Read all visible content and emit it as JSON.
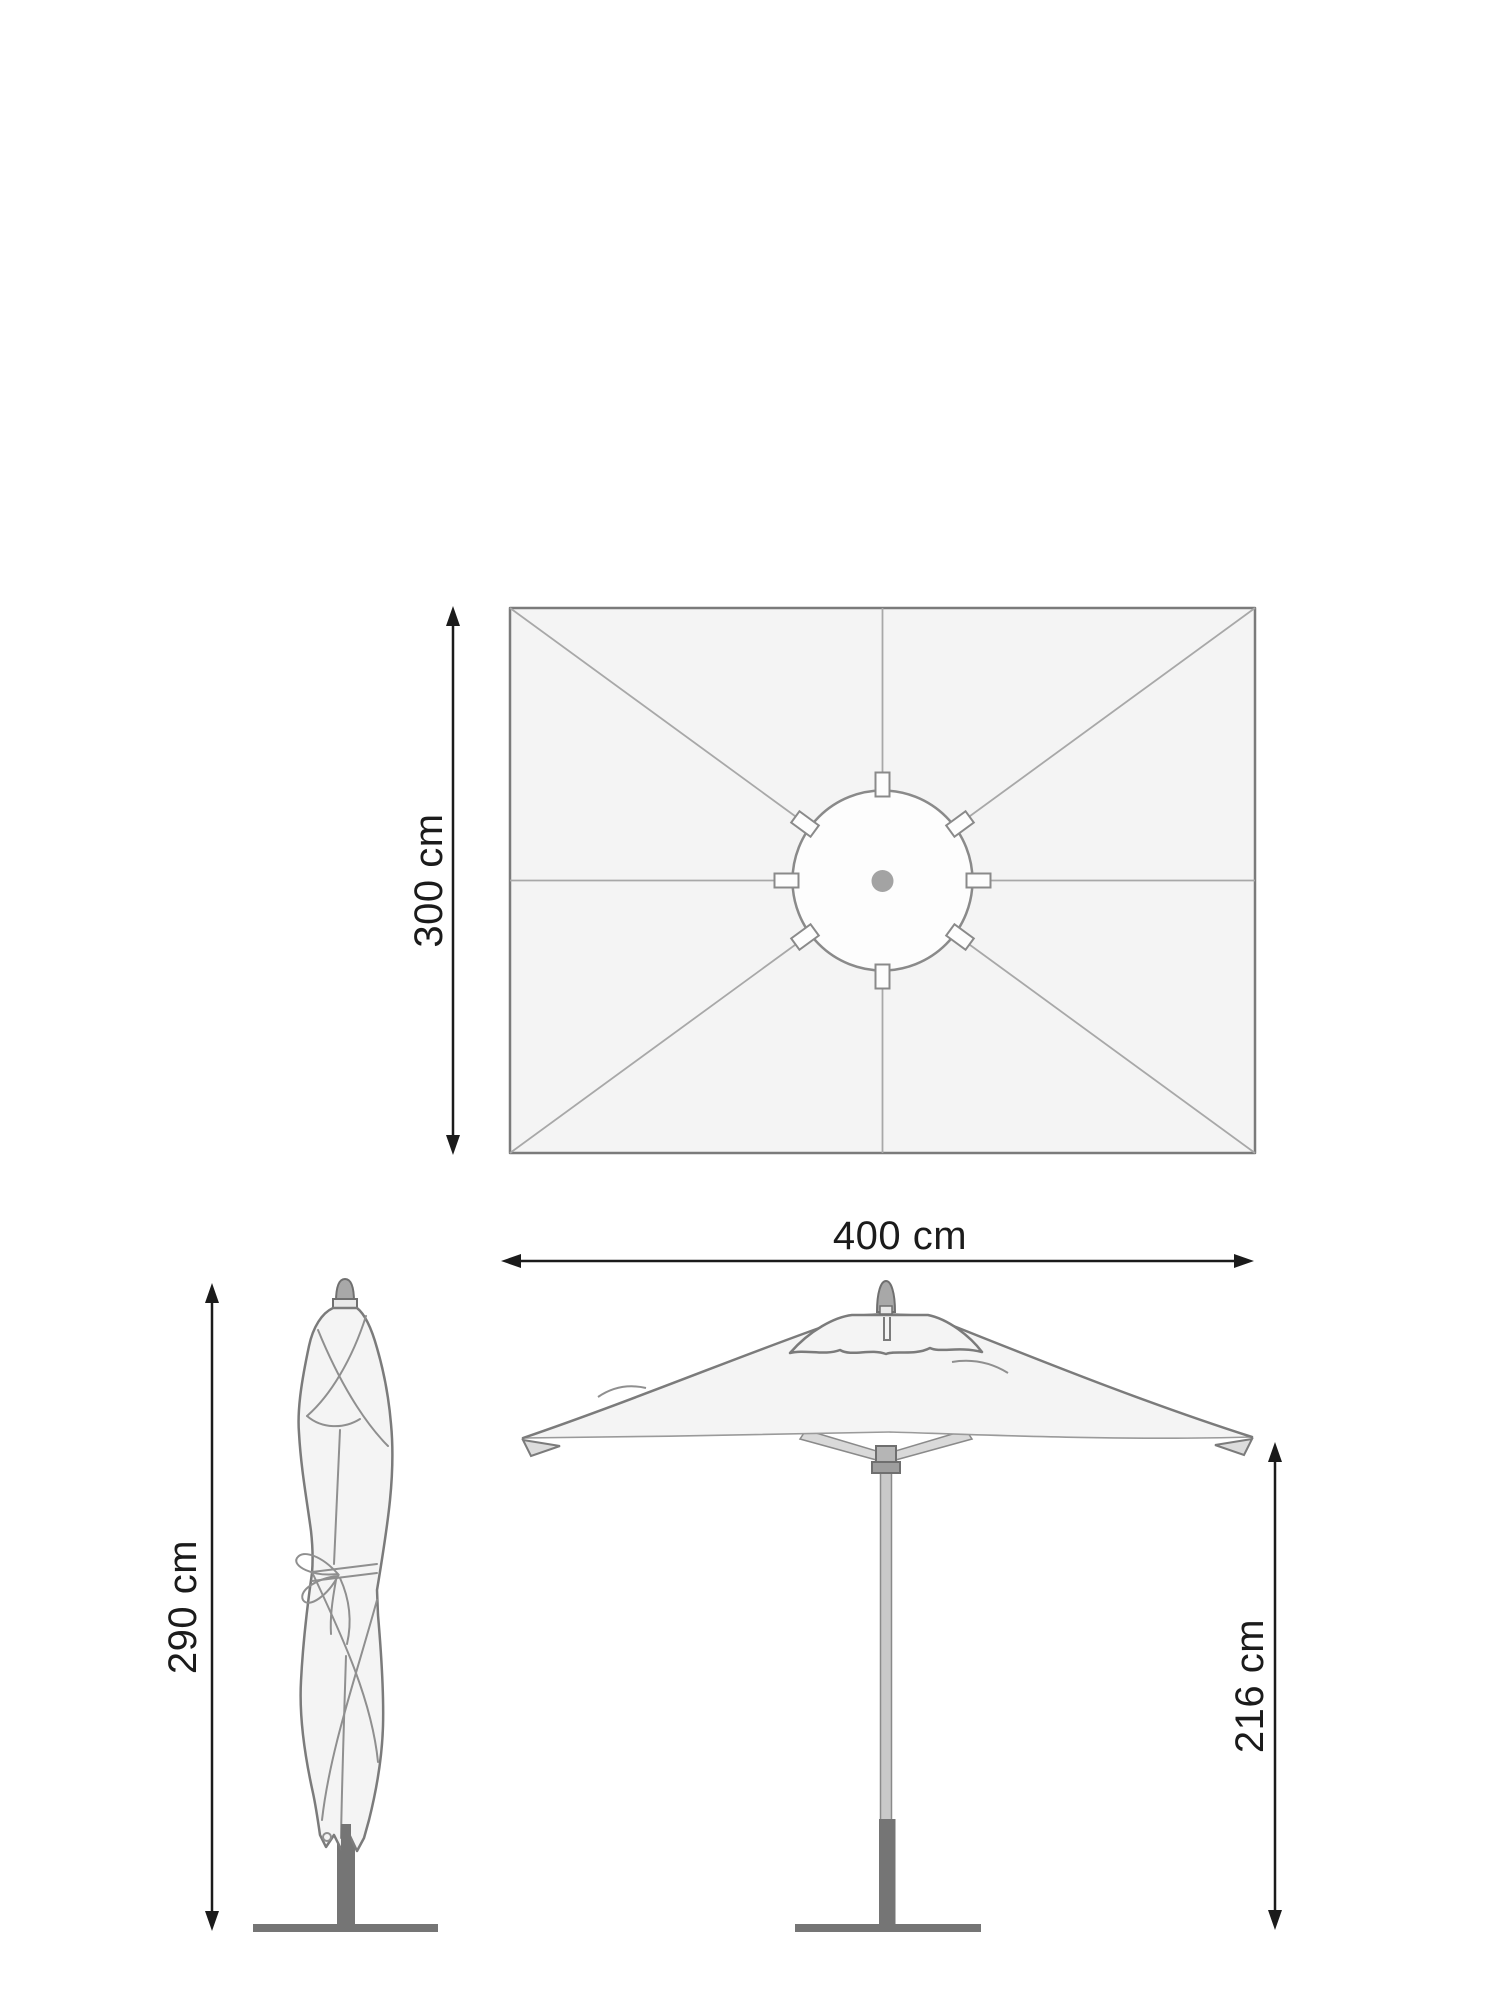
{
  "diagram": {
    "title": "parasol-dimension-diagram",
    "labels": {
      "top_view_depth": "300 cm",
      "top_view_width": "400 cm",
      "closed_height": "290 cm",
      "open_clearance_height": "216 cm"
    },
    "views": {
      "top_view": "rectangular canopy seen from above with 8 ribs and center hub",
      "closed_view": "folded parasol tied with ribbon on stand",
      "open_view": "open parasol on pole with base"
    },
    "colors": {
      "background": "#ffffff",
      "canopy_fill": "#f4f4f4",
      "canopy_outline": "#7b7b7b",
      "rib_line": "#a8a8a8",
      "fold_line": "#8f8f8f",
      "dimension_ink": "#1b1b1b",
      "metal_dark": "#757575",
      "metal_mid": "#a8a8a8",
      "metal_light": "#c9c9c9"
    }
  }
}
